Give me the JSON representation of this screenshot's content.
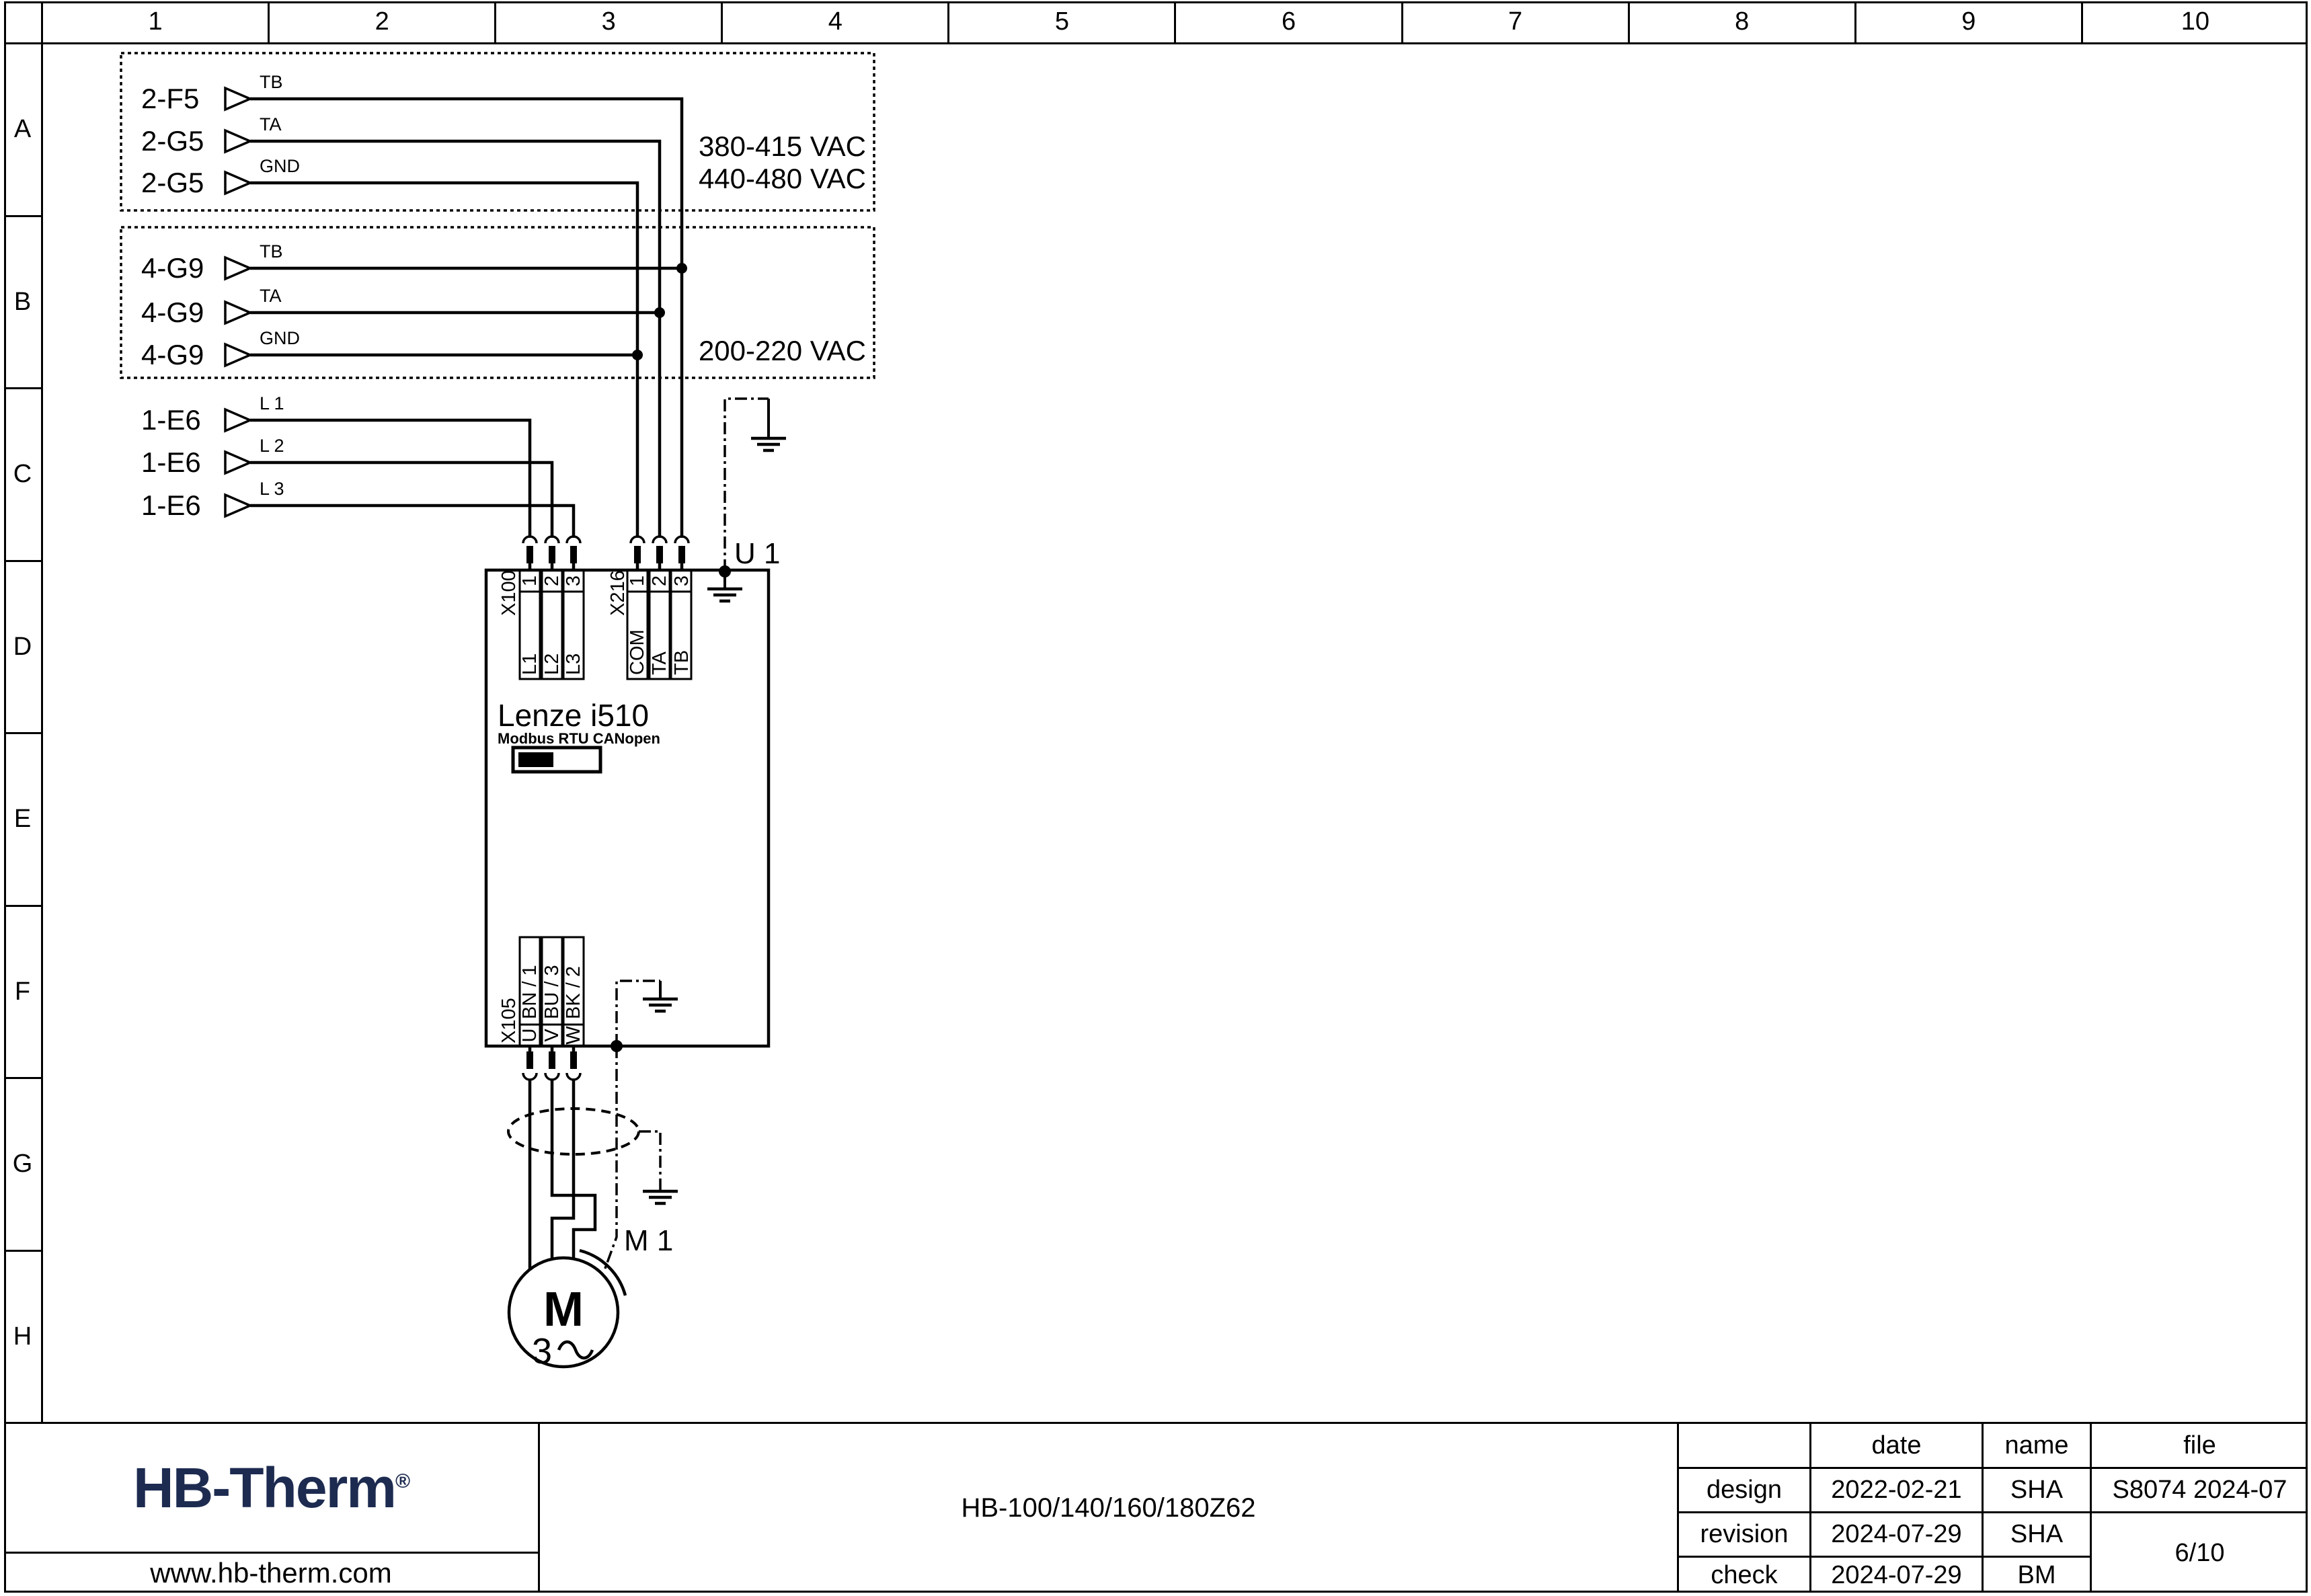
{
  "frame": {
    "columns": [
      "1",
      "2",
      "3",
      "4",
      "5",
      "6",
      "7",
      "8",
      "9",
      "10"
    ],
    "rows": [
      "A",
      "B",
      "C",
      "D",
      "E",
      "F",
      "G",
      "H"
    ]
  },
  "hv_box": {
    "rows": [
      {
        "device": "2-F5",
        "signal": "TB"
      },
      {
        "device": "2-G5",
        "signal": "TA"
      },
      {
        "device": "2-G5",
        "signal": "GND"
      }
    ],
    "voltage_1": "380-415 VAC",
    "voltage_2": "440-480 VAC"
  },
  "control_box": {
    "rows": [
      {
        "device": "4-G9",
        "signal": "TB"
      },
      {
        "device": "4-G9",
        "signal": "TA"
      },
      {
        "device": "4-G9",
        "signal": "GND"
      }
    ],
    "voltage": "200-220 VAC"
  },
  "mains": {
    "rows": [
      {
        "device": "1-E6",
        "signal": "L 1"
      },
      {
        "device": "1-E6",
        "signal": "L 2"
      },
      {
        "device": "1-E6",
        "signal": "L 3"
      }
    ]
  },
  "drive": {
    "designation": "U 1",
    "model": "Lenze i510",
    "comm_label": "Modbus RTU CANopen",
    "x100": {
      "label": "X100",
      "pins": [
        "1",
        "2",
        "3"
      ],
      "signals": [
        "L1",
        "L2",
        "L3"
      ]
    },
    "x216": {
      "label": "X216",
      "pins": [
        "1",
        "2",
        "3"
      ],
      "signals": [
        "COM",
        "TA",
        "TB"
      ]
    },
    "x105": {
      "label": "X105",
      "signals": [
        "BN / 1",
        "BU / 3",
        "BK / 2"
      ],
      "terminals": [
        "U",
        "V",
        "W"
      ]
    }
  },
  "motor": {
    "designation": "M 1",
    "letter": "M",
    "phases": "3"
  },
  "title_block": {
    "logo_text": "HB-Therm",
    "registered": "®",
    "website": "www.hb-therm.com",
    "product_code": "HB-100/140/160/180Z62",
    "col_date": "date",
    "col_name": "name",
    "col_file": "file",
    "rows": [
      {
        "label": "design",
        "date": "2022-02-21",
        "name": "SHA"
      },
      {
        "label": "revision",
        "date": "2024-07-29",
        "name": "SHA"
      },
      {
        "label": "check",
        "date": "2024-07-29",
        "name": "BM"
      }
    ],
    "file_number": "S8074 2024-07",
    "sheet": "6/10"
  },
  "colors": {
    "logo": "#1d2b50",
    "line": "#000000"
  }
}
